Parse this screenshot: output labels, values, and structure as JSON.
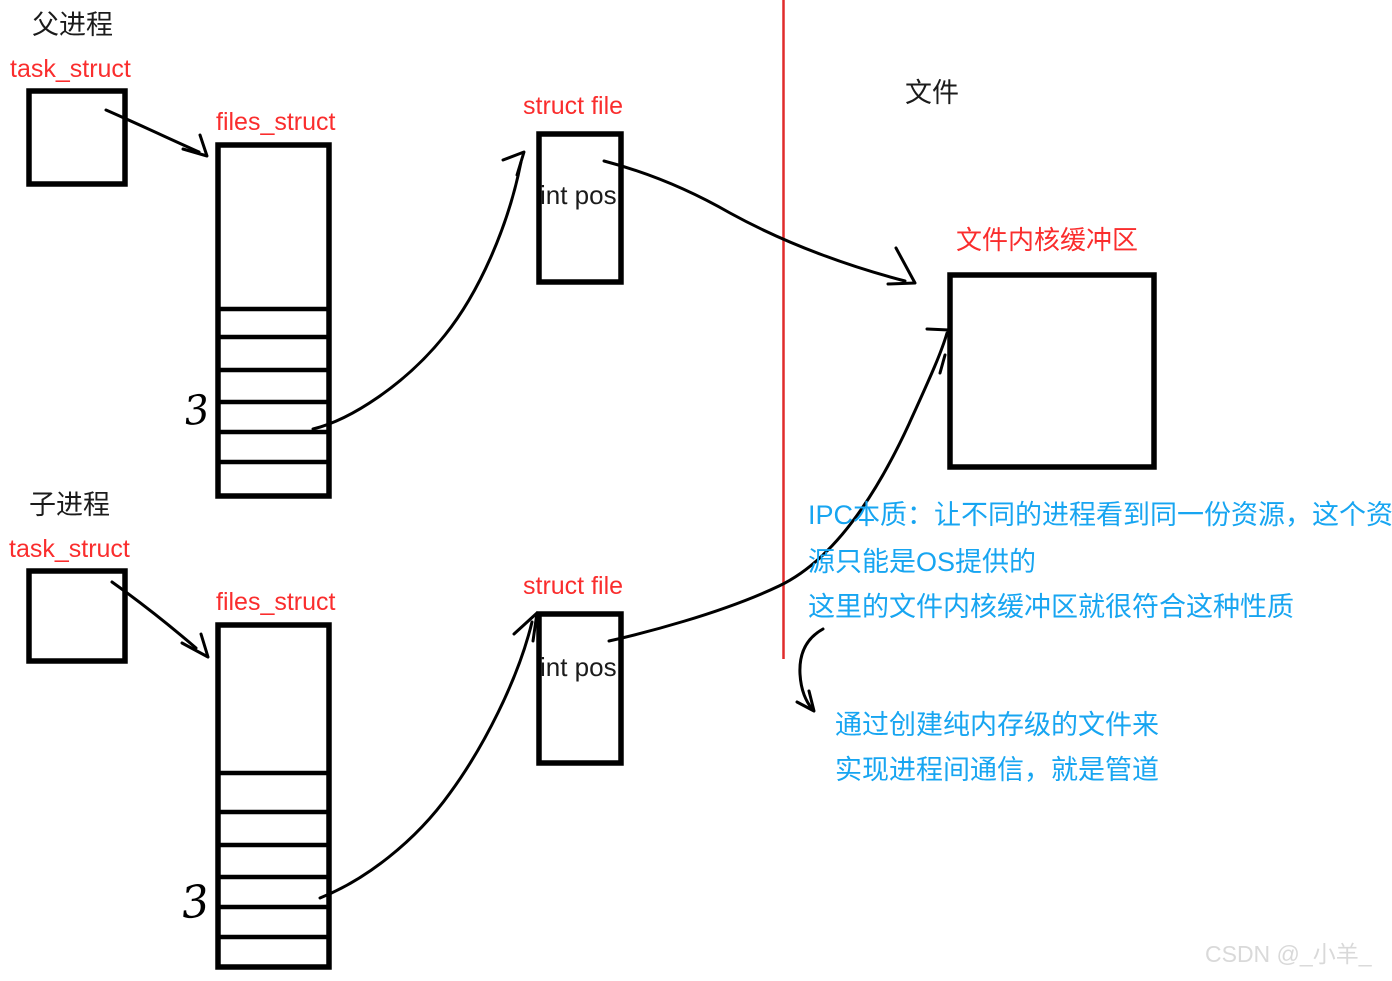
{
  "colors": {
    "ink_black": "#000000",
    "label_red": "#fa2d2d",
    "divider_red": "#e02b2b",
    "note_blue": "#17a5f1",
    "watermark_gray": "#d9d9d9"
  },
  "parent": {
    "title": "父进程",
    "task_struct": "task_struct",
    "files_struct": "files_struct",
    "fd_index": "3",
    "struct_file": "struct file",
    "file_field": "int pos"
  },
  "child": {
    "title": "子进程",
    "task_struct": "task_struct",
    "files_struct": "files_struct",
    "fd_index": "3",
    "struct_file": "struct file",
    "file_field": "int pos"
  },
  "file_area": {
    "title": "文件",
    "buffer_label": "文件内核缓冲区"
  },
  "notes": {
    "ipc_1": "IPC本质：让不同的进程看到同一份资源，这个资",
    "ipc_2": "源只能是OS提供的",
    "ipc_3": "这里的文件内核缓冲区就很符合这种性质",
    "pipe_1": "通过创建纯内存级的文件来",
    "pipe_2": "实现进程间通信，就是管道"
  },
  "watermark": "CSDN @_小羊_"
}
